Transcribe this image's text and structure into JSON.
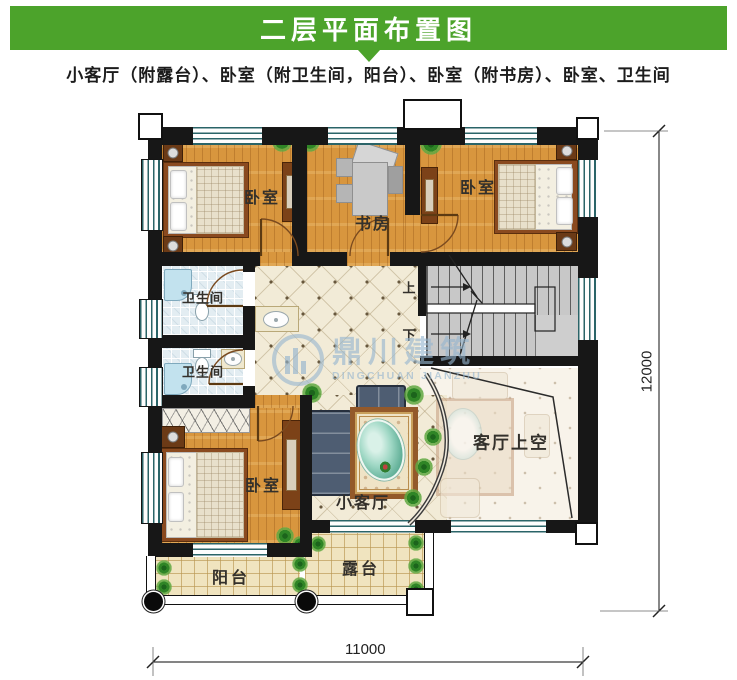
{
  "header": {
    "title": "二层平面布置图"
  },
  "subtitle": "小客厅（附露台）、卧室（附卫生间，阳台）、卧室（附书房）、卧室、卫生间",
  "rooms": {
    "bedroom_top_left": "卧室",
    "study": "书房",
    "bedroom_top_right": "卧室",
    "bathroom_upper": "卫生间",
    "bathroom_lower": "卫生间",
    "bedroom_bottom_left": "卧室",
    "small_living_room": "小客厅",
    "living_room_void": "客厅上空",
    "balcony": "阳台",
    "terrace": "露台"
  },
  "stairs": {
    "up_label": "上",
    "down_label": "下"
  },
  "dimensions": {
    "width_mm": "11000",
    "height_mm": "12000"
  },
  "watermark": {
    "name_cn": "鼎川建筑",
    "name_en": "DINGCHUAN JIANZHU"
  },
  "colors": {
    "header_green": "#4ca32b",
    "wall": "#171717",
    "wood_floor": "#d8963e",
    "hall_tile": "#f2ebd7",
    "bathroom_tile": "#e3edf2",
    "stair_gray": "#c8c8c8",
    "balcony_tile": "#f0e4bf"
  }
}
